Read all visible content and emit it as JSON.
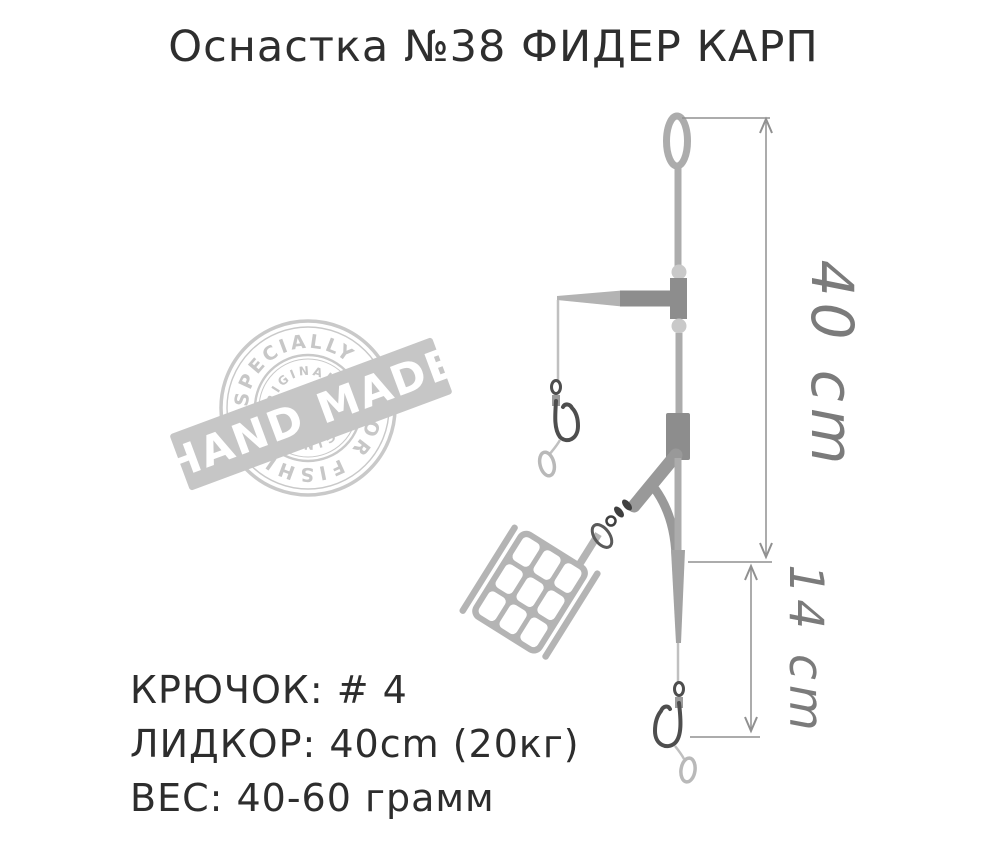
{
  "title": "Оснастка №38 ФИДЕР КАРП",
  "stamp": {
    "arc_top": "ESPECIALLY",
    "arc_bottom": "FOR FISHING",
    "inner_top": "ORIGINAL",
    "inner_bottom": "ORIGINAL",
    "banner": "HAND MADE"
  },
  "dimensions": {
    "upper": "40 cm",
    "lower": "14 cm"
  },
  "specs": [
    "КРЮЧОК: # 4",
    "ЛИДКОР: 40cm (20кг)",
    "ВЕС: 40-60 грамм"
  ],
  "colors": {
    "text": "#2e2e2e",
    "stamp": "#c9c9c9",
    "banner_text": "#ffffff",
    "line": "#acacac",
    "connector": "#8d8d8d",
    "hook": "#4e4e4e",
    "dimension": "#909090",
    "dimension_text": "#7b7b7b",
    "feeder": "#b4b4b4"
  }
}
